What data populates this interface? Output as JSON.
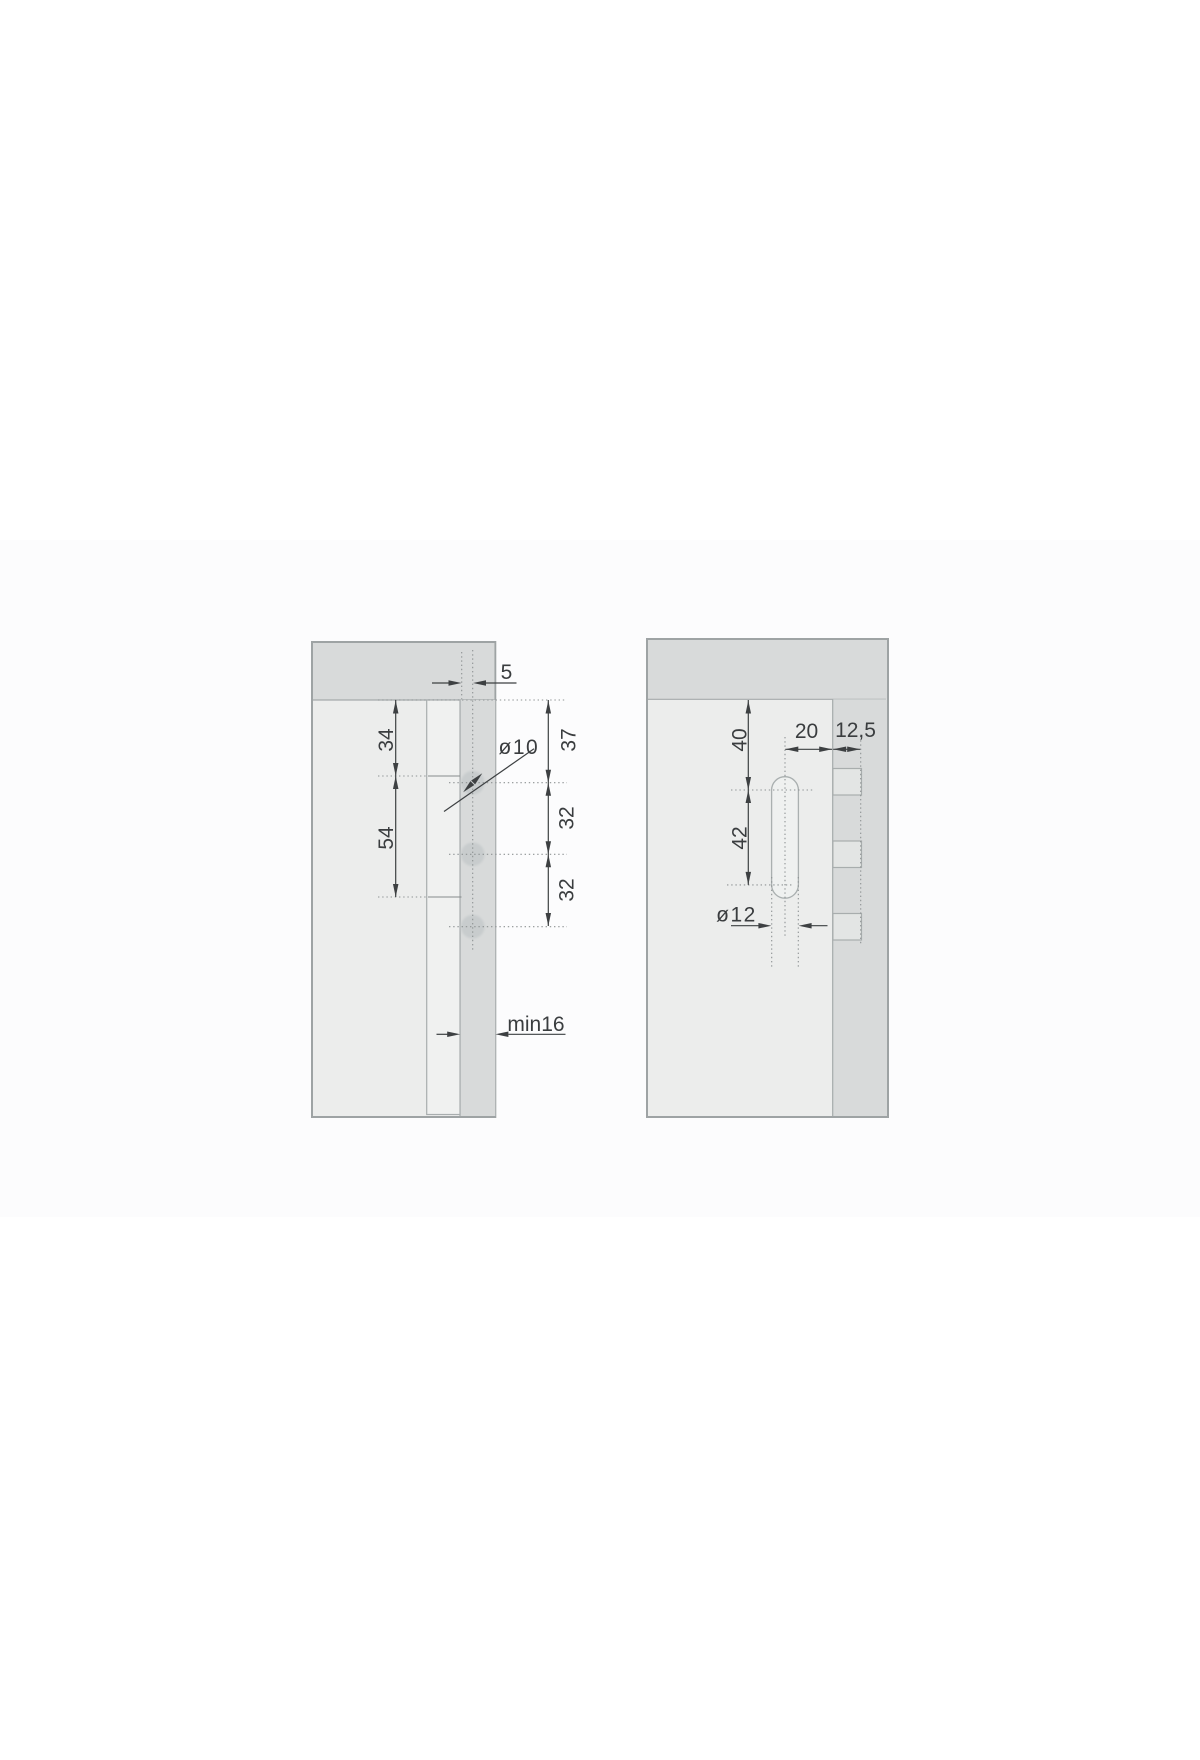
{
  "page": {
    "background": "#ffffff",
    "band_color": "#fcfcfd",
    "description": "technical mounting drawing, two panel views"
  },
  "colors": {
    "panel_dark": "#d8dada",
    "panel_light": "#ecedec",
    "rail_fill": "#f0f1f0",
    "tab_fill": "#e3e5e4",
    "hole_fill": "#c8cccd",
    "outline": "#a5aaab",
    "dim_line": "#3d4042",
    "dotted_line": "#8e9394"
  },
  "views": {
    "left": {
      "name": "side-section-view",
      "labels": {
        "edge_offset": "5",
        "top_to_mark": "34",
        "mark_span": "54",
        "top_to_first_hole": "37",
        "hole_spacing_a": "32",
        "hole_spacing_b": "32",
        "hole_diameter": "ø10",
        "min_thickness": "min16"
      }
    },
    "right": {
      "name": "front-view",
      "labels": {
        "top_to_slot": "40",
        "slot_length": "42",
        "axis_to_edge": "20",
        "pin_depth": "12,5",
        "slot_width": "ø12"
      }
    }
  }
}
